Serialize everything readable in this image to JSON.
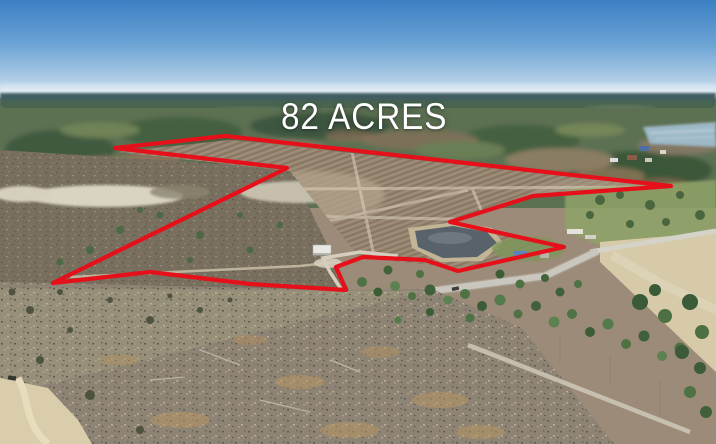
{
  "label": {
    "acreage": "82 ACRES",
    "color": "#ffffff"
  },
  "boundary": {
    "color": "#e6101a",
    "stroke_width": "4.2",
    "points": "115,148 225,136 671,186 533,196 450,222 564,247 458,271 425,260 363,257 336,267 346,290 250,284 150,272 53,283 287,168"
  },
  "palette": {
    "sky_top": "#3b7fc4",
    "sky_horizon": "#e4edf3",
    "distant_forest": "#3f5d64",
    "mid_forest": "#5c7052",
    "field_rows": "#9d8c78",
    "winter_woods": "#786f5f",
    "sand_clearing": "#d8d3c3",
    "pond_water": "#57626b",
    "road": "#c9c6bd",
    "scrub_foreground": "#8d8476",
    "pine_green": "#4f7244",
    "pale_field": "#d6caa9",
    "lake": "#9db8c7"
  }
}
